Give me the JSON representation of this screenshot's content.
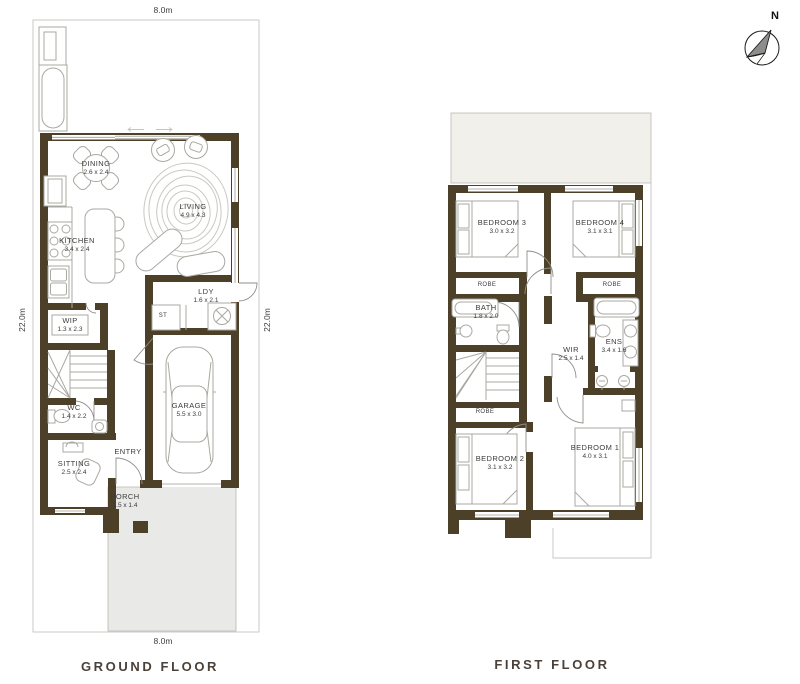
{
  "compass": {
    "north_label": "N"
  },
  "ground_floor": {
    "title": "GROUND FLOOR",
    "dim_top": "8.0m",
    "dim_bottom": "8.0m",
    "dim_left": "22.0m",
    "dim_right": "22.0m",
    "rooms": {
      "dining": {
        "name": "DINING",
        "size": "2.6 x 2.4"
      },
      "living": {
        "name": "LIVING",
        "size": "4.9 x 4.3"
      },
      "kitchen": {
        "name": "KITCHEN",
        "size": "3.4 x 2.4"
      },
      "ldy": {
        "name": "LDY",
        "size": "1.6 x 2.1"
      },
      "st": {
        "name": "ST"
      },
      "wip": {
        "name": "WIP",
        "size": "1.3 x 2.3"
      },
      "wc": {
        "name": "WC",
        "size": "1.4 x 2.2"
      },
      "garage": {
        "name": "GARAGE",
        "size": "5.5 x 3.0"
      },
      "sitting": {
        "name": "SITTING",
        "size": "2.5 x 2.4"
      },
      "entry": {
        "name": "ENTRY"
      },
      "porch": {
        "name": "PORCH",
        "size": "1.5 x 1.4"
      }
    }
  },
  "first_floor": {
    "title": "FIRST FLOOR",
    "rooms": {
      "bedroom3": {
        "name": "BEDROOM 3",
        "size": "3.0 x 3.2"
      },
      "bedroom4": {
        "name": "BEDROOM 4",
        "size": "3.1 x 3.1"
      },
      "bath": {
        "name": "BATH",
        "size": "1.8 x 2.0"
      },
      "wir": {
        "name": "WIR",
        "size": "2.5 x 1.4"
      },
      "ens": {
        "name": "ENS",
        "size": "3.4 x 1.6"
      },
      "bedroom2": {
        "name": "BEDROOM 2",
        "size": "3.1 x 3.2"
      },
      "bedroom1": {
        "name": "BEDROOM 1",
        "size": "4.0 x 3.1"
      },
      "robe": "ROBE"
    }
  }
}
